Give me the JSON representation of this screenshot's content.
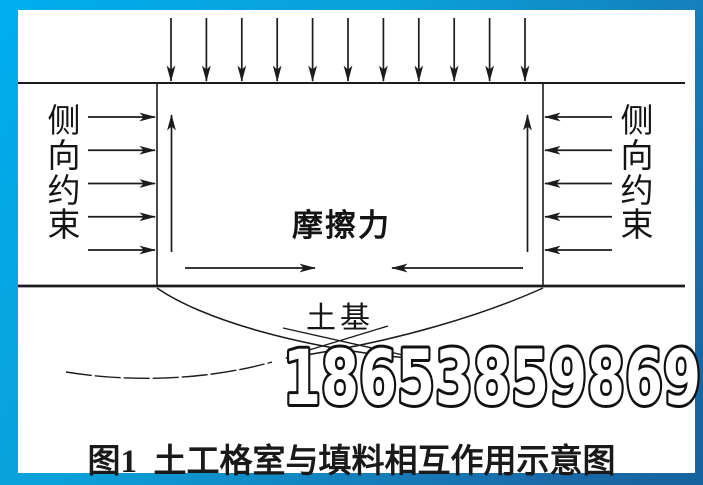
{
  "figure": {
    "caption": "图1  土工格室与填料相互作用示意图",
    "watermark": "18653859869",
    "labels": {
      "lateral_left": "侧向约束",
      "lateral_right": "侧向约束",
      "friction": "摩擦力",
      "subgrade": "土基"
    },
    "colors": {
      "border_gradient_start": "#00aeef",
      "border_gradient_end": "#15639e",
      "line": "#1c1c1c",
      "background": "#ffffff"
    },
    "geometry": {
      "top_load_arrows": {
        "count": 11,
        "x_first": 171,
        "x_last": 525,
        "y_tail": 18,
        "y_tip": 81
      },
      "left_confine_arrows": {
        "count": 5,
        "y_first": 117,
        "y_last": 250,
        "x_tail": 88,
        "x_tip": 155
      },
      "right_confine_arrows": {
        "count": 5,
        "y_first": 117,
        "y_last": 250,
        "x_tail": 612,
        "x_tip": 545
      },
      "up_arrows": {
        "xs": [
          171.5,
          527.5
        ],
        "y_tail": 252,
        "y_tip": 115
      },
      "friction_arrows": [
        {
          "x_tail": 185,
          "x_tip": 315,
          "y": 268
        },
        {
          "x_tail": 523,
          "x_tip": 392,
          "y": 268
        }
      ]
    }
  }
}
